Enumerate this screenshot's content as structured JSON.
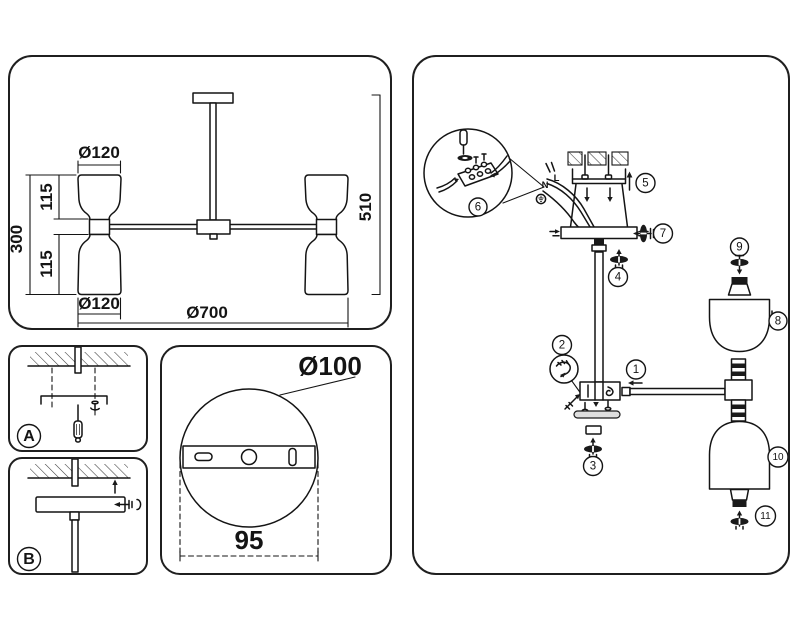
{
  "colors": {
    "ink": "#141414",
    "background": "#ffffff",
    "disc_gray": "#dedede"
  },
  "overview": {
    "shade_top_diameter": "Ø120",
    "upper_shade_height": "115",
    "lamp_height": "300",
    "lower_shade_height": "115",
    "shade_bottom_diameter": "Ø120",
    "fixture_diameter": "Ø700",
    "fixture_height": "510"
  },
  "steps": {
    "a": "A",
    "b": "B"
  },
  "plate": {
    "diameter": "Ø100",
    "hole_pitch": "95"
  },
  "assembly": {
    "neutral": "N",
    "live": "L",
    "callouts": [
      "1",
      "2",
      "3",
      "4",
      "5",
      "6",
      "7",
      "8",
      "9",
      "10",
      "11"
    ]
  }
}
